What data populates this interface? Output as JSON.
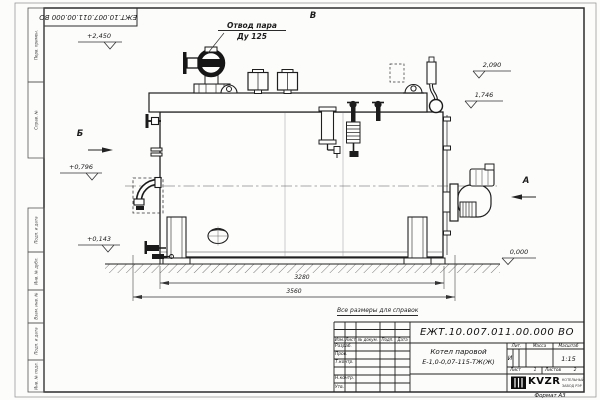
{
  "frame": {
    "doc_number_rotated": "ЕЖТ.10.007.011.00.000 ВО",
    "format": "Формат А3",
    "side_columns": [
      "Перв. примен.",
      "Справ. №",
      "Подп. и дата",
      "Инв. № дубл.",
      "Взам. инв. №",
      "Подп. и дата",
      "Инв. № подл."
    ]
  },
  "drawing": {
    "callout_line1": "Отвод пара",
    "callout_line2": "Ду 125",
    "view_a": "А",
    "view_b": "Б",
    "view_v": "В",
    "elevations": {
      "top": "+2,450",
      "e2090": "2,090",
      "e1746": "1,746",
      "e0796": "+0,796",
      "e0143": "+0,143",
      "ground": "0,000"
    },
    "dim_inner": "3280",
    "dim_outer": "3560",
    "note": "Все размеры для справок"
  },
  "title_block": {
    "doc_number": "ЕЖТ.10.007.011.00.000 ВО",
    "product_name": "Котел паровой",
    "product_code": "Е-1,0-0,07-115-ТЖ(Ж)",
    "col_izm": "Изм.",
    "col_list": "Лист",
    "col_doc": "№ докум.",
    "col_sign": "Подп.",
    "col_date": "Дата",
    "row_razrab": "Разраб.",
    "row_prov": "Пров.",
    "row_tkontr": "Т.контр.",
    "row_nkontr": "Н.контр.",
    "row_utv": "Утв.",
    "lit_label": "Лит.",
    "lit_value": "И",
    "mass_label": "Масса",
    "scale_label": "Масштаб",
    "scale_value": "1:15",
    "sheet_label": "Лист",
    "sheet_value": "1",
    "sheets_label": "Листов",
    "sheets_value": "2",
    "logo_text": "KVZR",
    "logo_line1": "КОТЕЛЬНЫЙ",
    "logo_line2": "ЗАВОД РЭР"
  }
}
